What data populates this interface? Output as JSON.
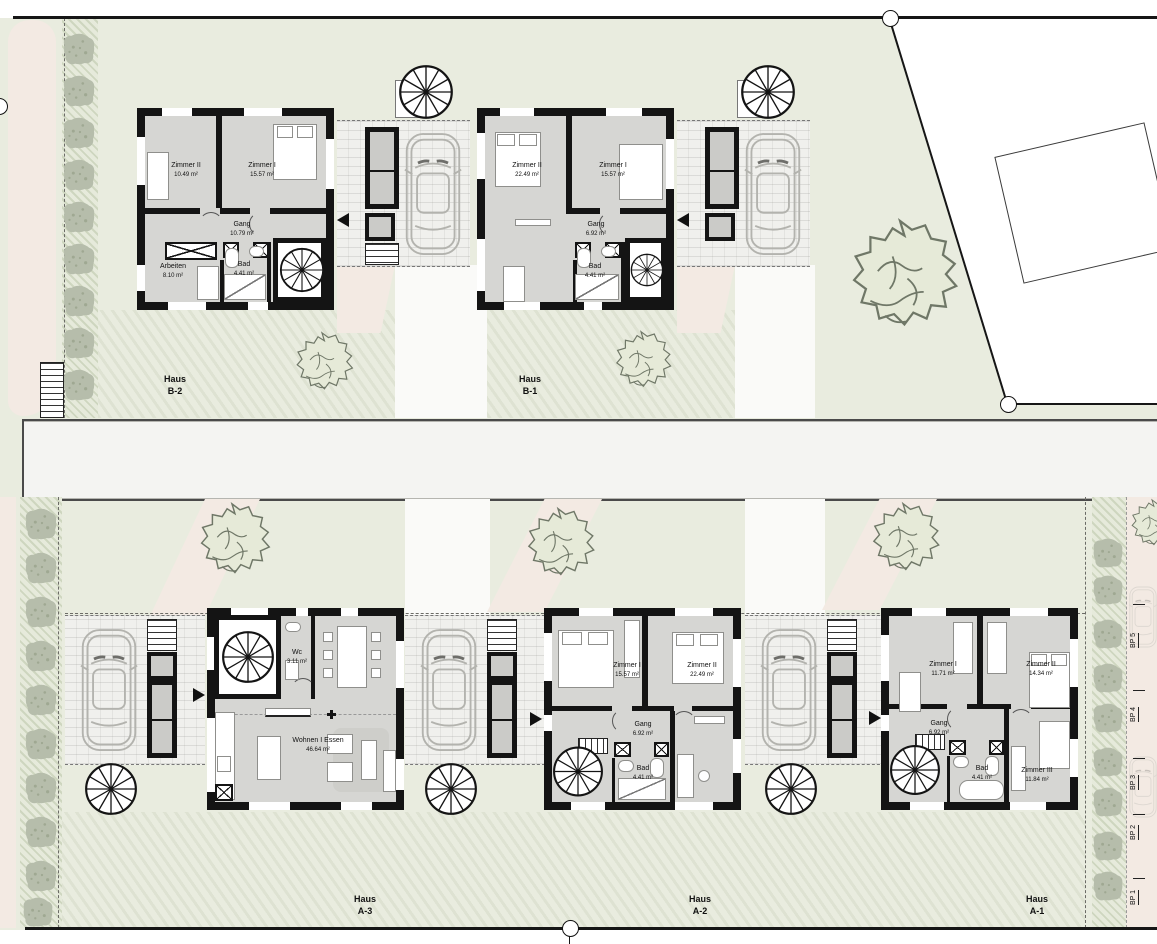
{
  "plan": {
    "houses": [
      {
        "label": "Haus",
        "code": "B-2",
        "rooms": {
          "zimmer2": {
            "name": "Zimmer II",
            "area": "10.49 m²"
          },
          "zimmer1": {
            "name": "Zimmer I",
            "area": "15.57 m²"
          },
          "gang": {
            "name": "Gang",
            "area": "10.79 m²"
          },
          "arbeiten": {
            "name": "Arbeiten",
            "area": "8.10 m²"
          },
          "bad": {
            "name": "Bad",
            "area": "4.41 m²"
          }
        }
      },
      {
        "label": "Haus",
        "code": "B-1",
        "rooms": {
          "zimmer2": {
            "name": "Zimmer II",
            "area": "22.49 m²"
          },
          "zimmer1": {
            "name": "Zimmer I",
            "area": "15.57 m²"
          },
          "gang": {
            "name": "Gang",
            "area": "6.92 m²"
          },
          "bad": {
            "name": "Bad",
            "area": "4.41 m²"
          }
        }
      },
      {
        "label": "Haus",
        "code": "A-3",
        "rooms": {
          "wc": {
            "name": "Wc",
            "area": "3.11 m²"
          },
          "wohnen": {
            "name": "Wohnen I Essen",
            "area": "46.64 m²"
          }
        }
      },
      {
        "label": "Haus",
        "code": "A-2",
        "rooms": {
          "zimmer1": {
            "name": "Zimmer I",
            "area": "15.57 m²"
          },
          "zimmer2": {
            "name": "Zimmer II",
            "area": "22.49 m²"
          },
          "gang": {
            "name": "Gang",
            "area": "6.92 m²"
          },
          "bad": {
            "name": "Bad",
            "area": "4.41 m²"
          }
        }
      },
      {
        "label": "Haus",
        "code": "A-1",
        "rooms": {
          "zimmer1": {
            "name": "Zimmer I",
            "area": "11.71 m²"
          },
          "zimmer2": {
            "name": "Zimmer II",
            "area": "14.34 m²"
          },
          "gang": {
            "name": "Gang",
            "area": "6.92 m²"
          },
          "bad": {
            "name": "Bad",
            "area": "4.41 m²"
          },
          "zimmer3": {
            "name": "Zimmer III",
            "area": "11.84 m²"
          }
        }
      }
    ],
    "parking_spots": [
      {
        "label": "BP 5"
      },
      {
        "label": "BP 4"
      },
      {
        "label": "BP 3"
      },
      {
        "label": "BP 2"
      },
      {
        "label": "BP 1"
      }
    ],
    "colors": {
      "site_green": "#e9ecdf",
      "path_pink": "#f3eae3",
      "house_floor": "#d6d6d3",
      "wall_black": "#141414",
      "road_grey": "#f4f4f2",
      "tree_grey_green": "#b6bdab"
    }
  }
}
